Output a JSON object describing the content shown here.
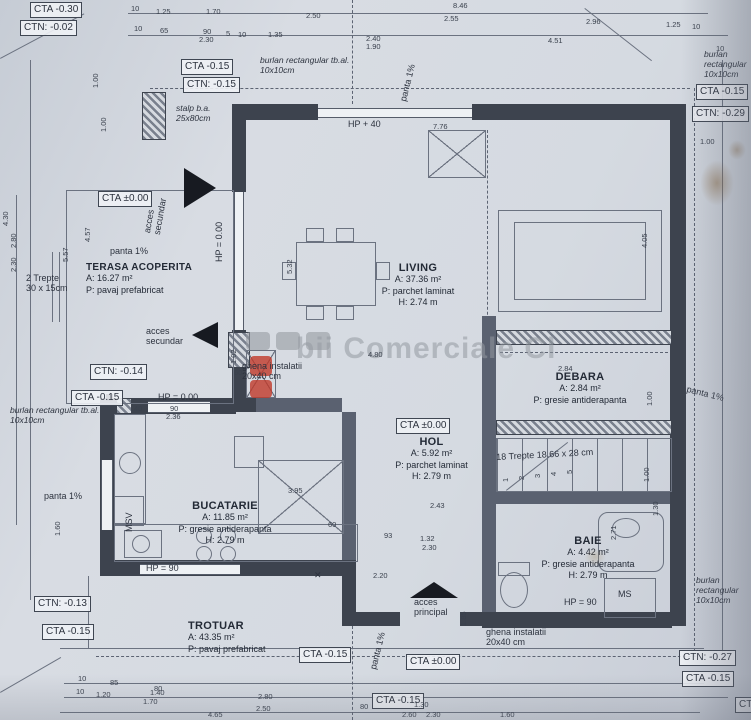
{
  "watermark": {
    "text": "bii Comerciale Cl"
  },
  "rooms": {
    "living": {
      "name": "LIVING",
      "area": "A: 37.36 m²",
      "floor": "P: parchet laminat",
      "height": "H: 2.74 m"
    },
    "debara": {
      "name": "DEBARA",
      "area": "A: 2.84 m²",
      "floor": "P: gresie antiderapanta",
      "height": ""
    },
    "hol": {
      "name": "HOL",
      "area": "A: 5.92 m²",
      "floor": "P: parchet laminat",
      "height": "H: 2.79 m"
    },
    "bucatarie": {
      "name": "BUCATARIE",
      "area": "A: 11.85 m²",
      "floor": "P: gresie antiderapanta",
      "height": "H: 2.79 m"
    },
    "baie": {
      "name": "BAIE",
      "area": "A: 4.42 m²",
      "floor": "P: gresie antiderapanta",
      "height": "H: 2.79 m"
    },
    "terasa": {
      "name": "TERASA ACOPERITA",
      "area": "A: 16.27 m²",
      "floor": "P: pavaj prefabricat",
      "height": ""
    },
    "trotuar": {
      "name": "TROTUAR",
      "area": "A: 43.35 m²",
      "floor": "P: pavaj prefabricat",
      "height": ""
    }
  },
  "labels": [
    {
      "t": "CTA -0.30",
      "x": 30,
      "y": 2,
      "c": "box"
    },
    {
      "t": "CTN: -0.02",
      "x": 20,
      "y": 20,
      "c": "box"
    },
    {
      "t": "CTA -0.15",
      "x": 181,
      "y": 59,
      "c": "box"
    },
    {
      "t": "CTN: -0.15",
      "x": 183,
      "y": 77,
      "c": "box"
    },
    {
      "t": "CTA ±0.00",
      "x": 98,
      "y": 191,
      "c": "box"
    },
    {
      "t": "CTN: -0.14",
      "x": 90,
      "y": 364,
      "c": "box"
    },
    {
      "t": "CTA -0.15",
      "x": 71,
      "y": 390,
      "c": "box"
    },
    {
      "t": "CTA -0.15",
      "x": 696,
      "y": 84,
      "c": "box"
    },
    {
      "t": "CTN: -0.29",
      "x": 692,
      "y": 106,
      "c": "box"
    },
    {
      "t": "CTA ±0.00",
      "x": 396,
      "y": 418,
      "c": "box"
    },
    {
      "t": "CTN: -0.13",
      "x": 34,
      "y": 596,
      "c": "box"
    },
    {
      "t": "CTA -0.15",
      "x": 42,
      "y": 624,
      "c": "box"
    },
    {
      "t": "CTA -0.15",
      "x": 299,
      "y": 647,
      "c": "box"
    },
    {
      "t": "CTA ±0.00",
      "x": 406,
      "y": 654,
      "c": "box"
    },
    {
      "t": "CTA -0.15",
      "x": 372,
      "y": 693,
      "c": "box"
    },
    {
      "t": "CTN: -0.27",
      "x": 679,
      "y": 650,
      "c": "box"
    },
    {
      "t": "CTA -0.15",
      "x": 682,
      "y": 671,
      "c": "box"
    },
    {
      "t": "CTA -0.15",
      "x": 735,
      "y": 697,
      "c": "box"
    },
    {
      "t": "burlan rectangular tb.al.\n10x10cm",
      "x": 260,
      "y": 56,
      "c": "note"
    },
    {
      "t": "burlan rectangular\n10x10cm",
      "x": 704,
      "y": 50,
      "c": "note"
    },
    {
      "t": "burlan rectangular tb.al.\n10x10cm",
      "x": 10,
      "y": 406,
      "c": "note"
    },
    {
      "t": "burlan rectangular\n10x10cm",
      "x": 696,
      "y": 576,
      "c": "note"
    },
    {
      "t": "stalp b.a.\n25x80cm",
      "x": 176,
      "y": 104,
      "c": "note"
    },
    {
      "t": "panta 1%",
      "x": 398,
      "y": 100,
      "rot": -76,
      "c": "ann"
    },
    {
      "t": "panta 1%",
      "x": 110,
      "y": 246,
      "c": "ann"
    },
    {
      "t": "panta 1%",
      "x": 688,
      "y": 384,
      "rot": 14,
      "c": "ann"
    },
    {
      "t": "panta 1%",
      "x": 44,
      "y": 491,
      "c": "ann"
    },
    {
      "t": "panta 1%",
      "x": 368,
      "y": 668,
      "rot": -76,
      "c": "ann"
    },
    {
      "t": "acces\nsecundar",
      "x": 142,
      "y": 232,
      "rot": -80,
      "c": "ann"
    },
    {
      "t": "acces\nsecundar",
      "x": 146,
      "y": 326,
      "c": "ann"
    },
    {
      "t": "acces\nprincipal",
      "x": 414,
      "y": 597,
      "c": "ann"
    },
    {
      "t": "HP = 0.00",
      "x": 214,
      "y": 262,
      "rot": -90,
      "c": "ann"
    },
    {
      "t": "HP = 0.00",
      "x": 158,
      "y": 392,
      "c": "ann"
    },
    {
      "t": "HP + 40",
      "x": 348,
      "y": 119,
      "c": "ann"
    },
    {
      "t": "HP = 90",
      "x": 146,
      "y": 563,
      "c": "ann"
    },
    {
      "t": "HP = 90",
      "x": 564,
      "y": 597,
      "c": "ann"
    },
    {
      "t": "MS",
      "x": 618,
      "y": 589,
      "c": "ann"
    },
    {
      "t": "MSV",
      "x": 124,
      "y": 532,
      "rot": -90,
      "c": "ann"
    },
    {
      "t": "2 Trepte\n30 x 15cm",
      "x": 26,
      "y": 273,
      "c": "ann"
    },
    {
      "t": "18 Trepte 18.66 x 28 cm",
      "x": 496,
      "y": 452,
      "rot": -3,
      "c": "ann"
    },
    {
      "t": "ghena instalatii\n20x40 cm",
      "x": 242,
      "y": 361,
      "c": "ann"
    },
    {
      "t": "ghena instalatii\n20x40 cm",
      "x": 486,
      "y": 627,
      "c": "ann"
    },
    {
      "t": "✕",
      "x": 314,
      "y": 570,
      "c": "ann"
    },
    {
      "t": "1",
      "x": 502,
      "y": 482,
      "rot": -90,
      "c": "dim"
    },
    {
      "t": "2",
      "x": 518,
      "y": 480,
      "rot": -90,
      "c": "dim"
    },
    {
      "t": "3",
      "x": 534,
      "y": 478,
      "rot": -90,
      "c": "dim"
    },
    {
      "t": "4",
      "x": 550,
      "y": 476,
      "rot": -90,
      "c": "dim"
    },
    {
      "t": "5",
      "x": 566,
      "y": 474,
      "rot": -90,
      "c": "dim"
    },
    {
      "t": "8.46",
      "x": 453,
      "y": 2,
      "c": "dim"
    },
    {
      "t": "10",
      "x": 131,
      "y": 5,
      "c": "dim"
    },
    {
      "t": "1.25",
      "x": 156,
      "y": 8,
      "c": "dim"
    },
    {
      "t": "1.70",
      "x": 206,
      "y": 8,
      "c": "dim"
    },
    {
      "t": "2.50",
      "x": 306,
      "y": 12,
      "c": "dim"
    },
    {
      "t": "2.55",
      "x": 444,
      "y": 15,
      "c": "dim"
    },
    {
      "t": "2.96",
      "x": 586,
      "y": 18,
      "c": "dim"
    },
    {
      "t": "1.25",
      "x": 666,
      "y": 21,
      "c": "dim"
    },
    {
      "t": "10",
      "x": 692,
      "y": 23,
      "c": "dim"
    },
    {
      "t": "10",
      "x": 134,
      "y": 25,
      "c": "dim"
    },
    {
      "t": "65",
      "x": 160,
      "y": 27,
      "c": "dim"
    },
    {
      "t": "90",
      "x": 203,
      "y": 28,
      "c": "dim"
    },
    {
      "t": "2.30",
      "x": 199,
      "y": 36,
      "c": "dim"
    },
    {
      "t": "5",
      "x": 226,
      "y": 30,
      "c": "dim"
    },
    {
      "t": "10",
      "x": 238,
      "y": 31,
      "c": "dim"
    },
    {
      "t": "1.35",
      "x": 268,
      "y": 31,
      "c": "dim"
    },
    {
      "t": "2.40",
      "x": 366,
      "y": 35,
      "c": "dim"
    },
    {
      "t": "1.90",
      "x": 366,
      "y": 43,
      "c": "dim"
    },
    {
      "t": "4.51",
      "x": 548,
      "y": 37,
      "c": "dim"
    },
    {
      "t": "10",
      "x": 716,
      "y": 45,
      "c": "dim"
    },
    {
      "t": "4.30",
      "x": 2,
      "y": 226,
      "rot": -90,
      "c": "dim"
    },
    {
      "t": "2.80",
      "x": 10,
      "y": 248,
      "rot": -90,
      "c": "dim"
    },
    {
      "t": "2.30",
      "x": 10,
      "y": 272,
      "rot": -90,
      "c": "dim"
    },
    {
      "t": "4.57",
      "x": 84,
      "y": 242,
      "rot": -90,
      "c": "dim"
    },
    {
      "t": "5.57",
      "x": 62,
      "y": 262,
      "rot": -90,
      "c": "dim"
    },
    {
      "t": "1.00",
      "x": 92,
      "y": 88,
      "rot": -90,
      "c": "dim"
    },
    {
      "t": "1.00",
      "x": 100,
      "y": 132,
      "rot": -90,
      "c": "dim"
    },
    {
      "t": "1.60",
      "x": 54,
      "y": 536,
      "rot": -90,
      "c": "dim"
    },
    {
      "t": "1.02",
      "x": 230,
      "y": 364,
      "rot": -90,
      "c": "dim"
    },
    {
      "t": "1.85",
      "x": 460,
      "y": 626,
      "rot": -90,
      "c": "dim"
    },
    {
      "t": "1.00",
      "x": 700,
      "y": 138,
      "c": "dim"
    },
    {
      "t": "4.05",
      "x": 641,
      "y": 248,
      "rot": -90,
      "c": "dim"
    },
    {
      "t": "2.84",
      "x": 558,
      "y": 365,
      "c": "dim"
    },
    {
      "t": "1.00",
      "x": 646,
      "y": 406,
      "rot": -90,
      "c": "dim"
    },
    {
      "t": "1.00",
      "x": 643,
      "y": 482,
      "rot": -90,
      "c": "dim"
    },
    {
      "t": "2.71",
      "x": 610,
      "y": 540,
      "rot": -90,
      "c": "dim"
    },
    {
      "t": "1.30",
      "x": 652,
      "y": 516,
      "rot": -90,
      "c": "dim"
    },
    {
      "t": "7.76",
      "x": 433,
      "y": 123,
      "c": "dim"
    },
    {
      "t": "5.32",
      "x": 286,
      "y": 274,
      "rot": -90,
      "c": "dim"
    },
    {
      "t": "4.80",
      "x": 368,
      "y": 351,
      "c": "dim"
    },
    {
      "t": "3.95",
      "x": 288,
      "y": 487,
      "c": "dim"
    },
    {
      "t": "2.43",
      "x": 430,
      "y": 502,
      "c": "dim"
    },
    {
      "t": "93",
      "x": 384,
      "y": 532,
      "c": "dim"
    },
    {
      "t": "1.32",
      "x": 420,
      "y": 535,
      "c": "dim"
    },
    {
      "t": "2.30",
      "x": 422,
      "y": 544,
      "c": "dim"
    },
    {
      "t": "60",
      "x": 328,
      "y": 521,
      "c": "dim"
    },
    {
      "t": "2.20",
      "x": 373,
      "y": 572,
      "c": "dim"
    },
    {
      "t": "90",
      "x": 170,
      "y": 405,
      "c": "dim"
    },
    {
      "t": "2.36",
      "x": 166,
      "y": 413,
      "c": "dim"
    },
    {
      "t": "40",
      "x": 134,
      "y": 405,
      "c": "dim"
    },
    {
      "t": "60",
      "x": 234,
      "y": 369,
      "c": "dim"
    },
    {
      "t": "10",
      "x": 78,
      "y": 675,
      "c": "dim"
    },
    {
      "t": "85",
      "x": 110,
      "y": 679,
      "c": "dim"
    },
    {
      "t": "80",
      "x": 154,
      "y": 685,
      "c": "dim"
    },
    {
      "t": "2.80",
      "x": 258,
      "y": 693,
      "c": "dim"
    },
    {
      "t": "10",
      "x": 76,
      "y": 688,
      "c": "dim"
    },
    {
      "t": "1.20",
      "x": 96,
      "y": 691,
      "c": "dim"
    },
    {
      "t": "1.40",
      "x": 150,
      "y": 689,
      "c": "dim"
    },
    {
      "t": "1.70",
      "x": 143,
      "y": 698,
      "c": "dim"
    },
    {
      "t": "2.50",
      "x": 256,
      "y": 705,
      "c": "dim"
    },
    {
      "t": "4.65",
      "x": 208,
      "y": 711,
      "c": "dim"
    },
    {
      "t": "80",
      "x": 360,
      "y": 703,
      "c": "dim"
    },
    {
      "t": "1.30",
      "x": 414,
      "y": 701,
      "c": "dim"
    },
    {
      "t": "2.60",
      "x": 402,
      "y": 711,
      "c": "dim"
    },
    {
      "t": "2.30",
      "x": 426,
      "y": 711,
      "c": "dim"
    },
    {
      "t": "1.60",
      "x": 500,
      "y": 711,
      "c": "dim"
    }
  ]
}
